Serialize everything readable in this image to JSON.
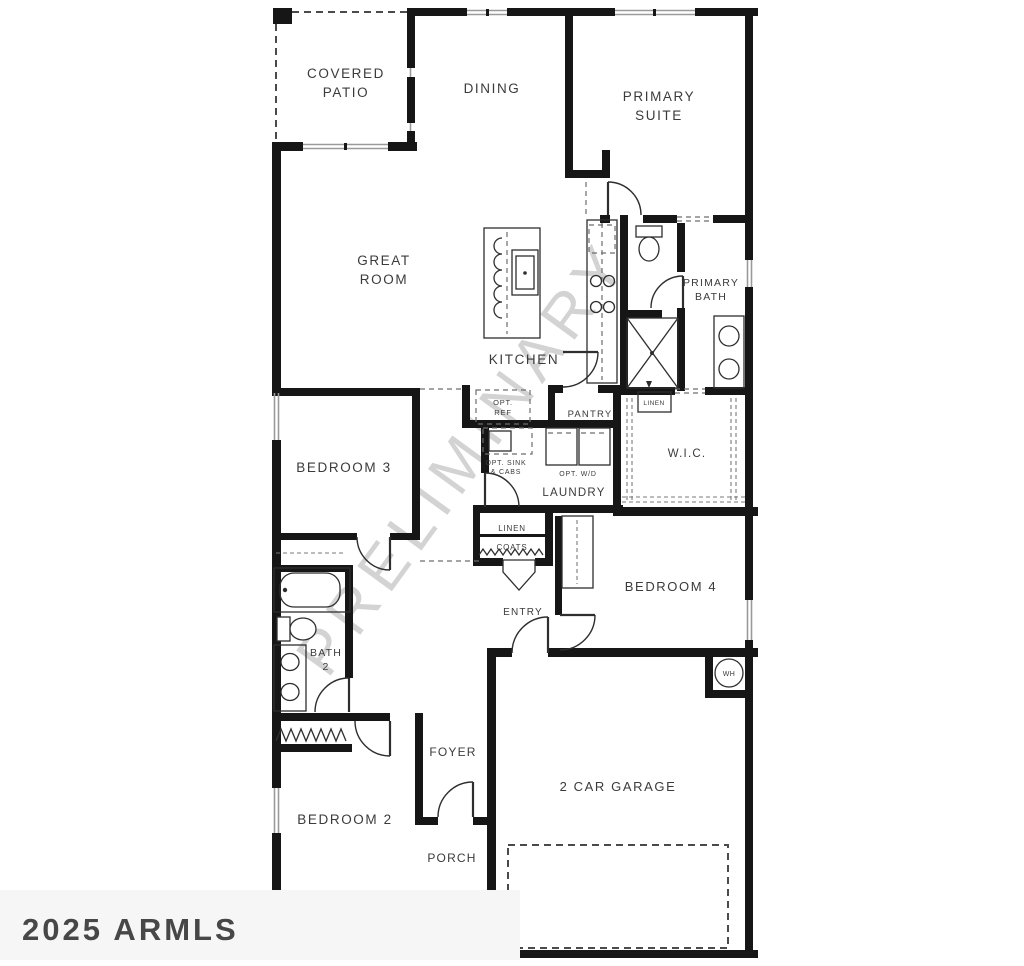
{
  "watermarks": {
    "preliminary": "PRELIMINARY",
    "armls": "2025 ARMLS"
  },
  "rooms": {
    "covered_patio": {
      "line1": "COVERED",
      "line2": "PATIO"
    },
    "dining": {
      "label": "DINING"
    },
    "primary_suite": {
      "line1": "PRIMARY",
      "line2": "SUITE"
    },
    "great_room": {
      "line1": "GREAT",
      "line2": "ROOM"
    },
    "primary_bath": {
      "line1": "PRIMARY",
      "line2": "BATH"
    },
    "kitchen": {
      "label": "KITCHEN"
    },
    "pantry": {
      "label": "PANTRY"
    },
    "laundry": {
      "label": "LAUNDRY"
    },
    "wic": {
      "label": "W.I.C."
    },
    "bedroom3": {
      "label": "BEDROOM 3"
    },
    "bedroom4": {
      "label": "BEDROOM 4"
    },
    "bath2": {
      "line1": "BATH",
      "line2": "2"
    },
    "entry": {
      "label": "ENTRY"
    },
    "foyer": {
      "label": "FOYER"
    },
    "bedroom2": {
      "label": "BEDROOM 2"
    },
    "porch": {
      "label": "PORCH"
    },
    "garage": {
      "label": "2 CAR GARAGE"
    }
  },
  "features": {
    "opt_ref": {
      "line1": "OPT.",
      "line2": "REF"
    },
    "opt_sink": {
      "line1": "OPT. SINK",
      "line2": "& CABS"
    },
    "opt_wd": {
      "label": "OPT. W/D"
    },
    "linen_hall": {
      "label": "LINEN"
    },
    "coats": {
      "label": "COATS"
    },
    "linen_wic": {
      "label": "LINEN"
    },
    "water_heater": {
      "label": "WH"
    }
  },
  "colors": {
    "wall": "#161616",
    "fixture_line": "#2e2e2e",
    "label": "#3b3b3b",
    "watermark_gray": "#a9a9a9",
    "armls_stamp": "#2f2f2f",
    "background": "#ffffff"
  }
}
